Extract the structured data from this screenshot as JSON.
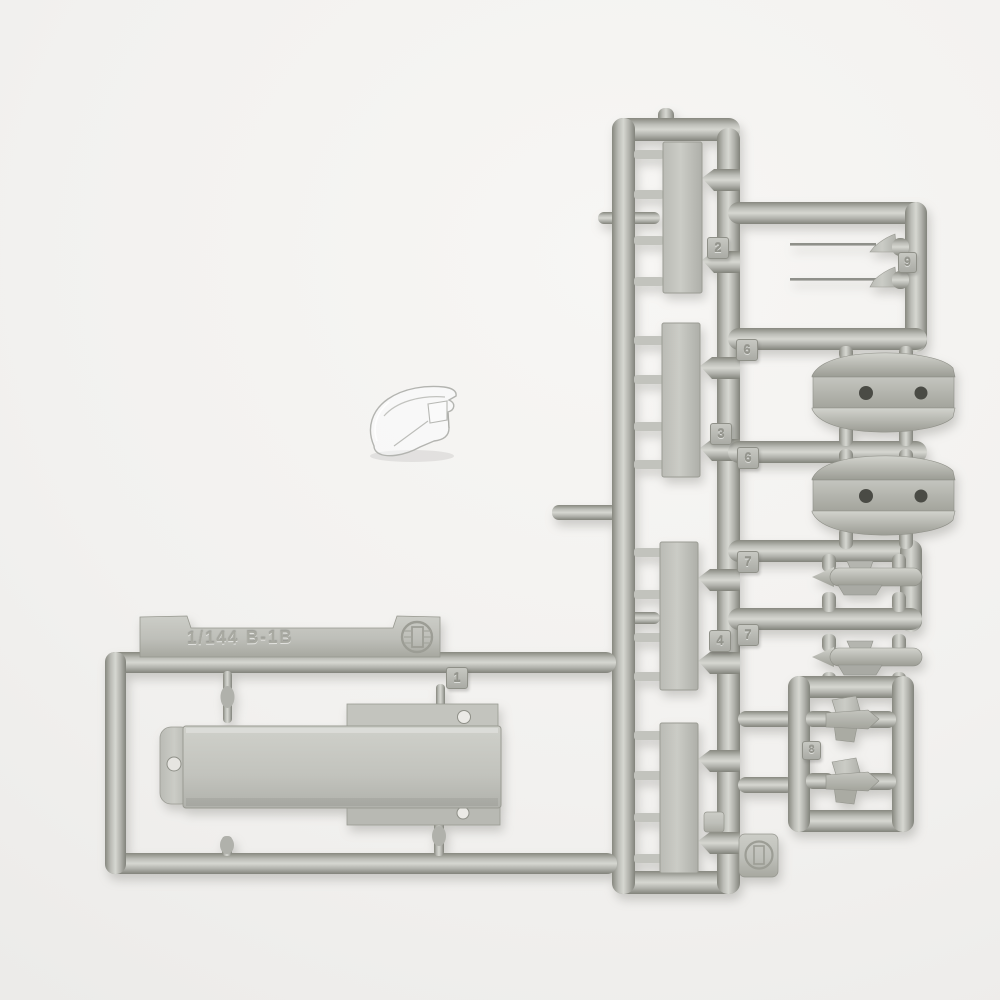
{
  "photo": {
    "scale_label": "1/144 B-1B",
    "tags": {
      "t1": "1",
      "t2": "2",
      "t3": "3",
      "t4": "4",
      "t6a": "6",
      "t6b": "6",
      "t7a": "7",
      "t7b": "7",
      "t8": "8",
      "t9": "9"
    },
    "colors": {
      "background": "#f2f1ef",
      "sprue_mid": "#b7b8b2",
      "sprue_highlight": "#d6d7d1",
      "sprue_shadow": "#86877f",
      "part_face": "#c6c7c1",
      "nacelle_hole": "#4a4b45",
      "clear_part": "rgba(252,252,253,0.5)"
    }
  }
}
